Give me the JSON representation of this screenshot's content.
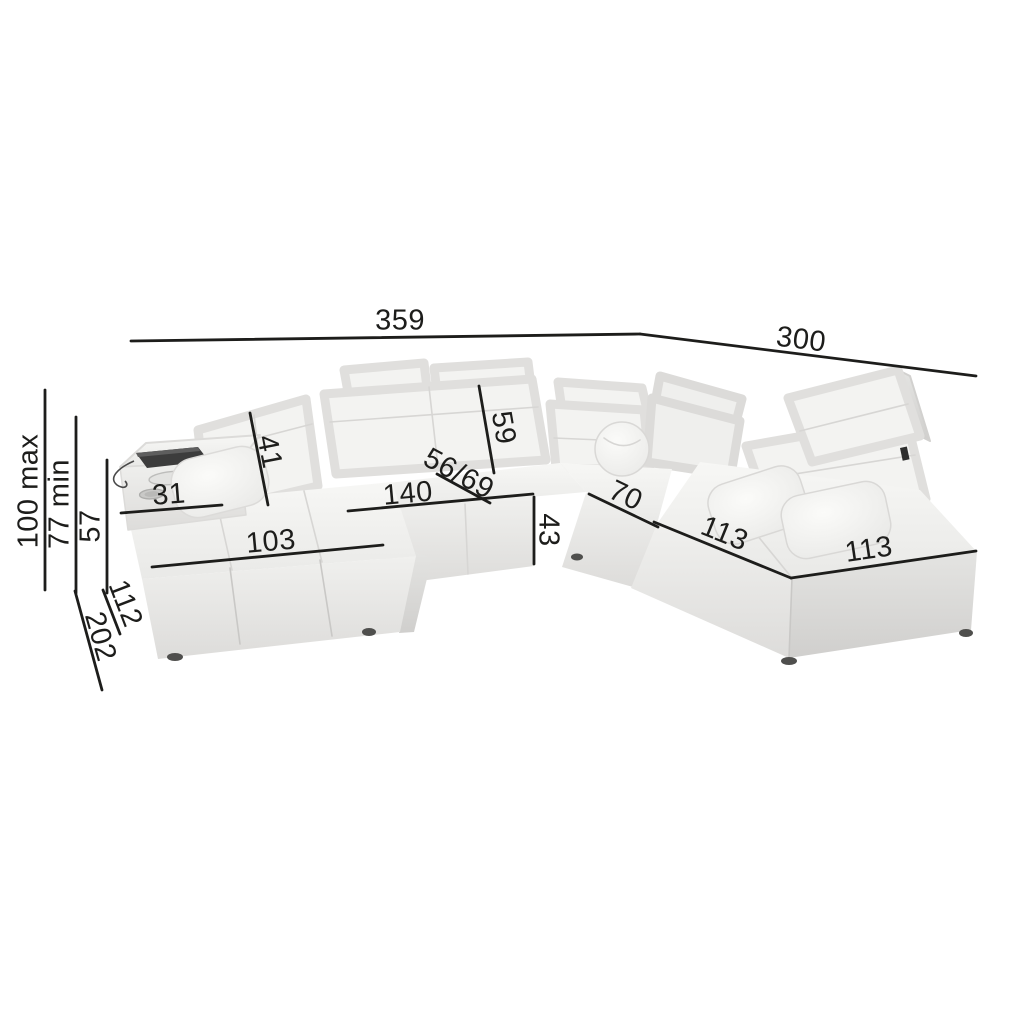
{
  "diagram": {
    "type": "furniture-dimension-diagram",
    "subject": "modular corner sofa with adjustable headrests and armrest console",
    "colors": {
      "background": "#ffffff",
      "dimension_line": "#1d1d1b",
      "label_text": "#1d1d1b",
      "sofa_top": "#f5f5f3",
      "sofa_front": "#e9e9e7",
      "sofa_side_shadow": "#d6d5d3",
      "console_tray": "#3c3c3c"
    },
    "dimensions": {
      "total_width": "359",
      "total_depth": "300",
      "height_max": "100 max",
      "height_min": "77 min",
      "armrest_height": "57",
      "chaise_side_depth": "112",
      "total_side_depth": "202",
      "left_backrest_width": "41",
      "console_width": "31",
      "chaise_width": "103",
      "center_seat_width": "140",
      "center_backrest_width": "59",
      "seat_depth": "56/69",
      "seat_height": "43",
      "corner_seat_width": "70",
      "right_seat_width": "113",
      "end_seat_width": "113"
    }
  }
}
